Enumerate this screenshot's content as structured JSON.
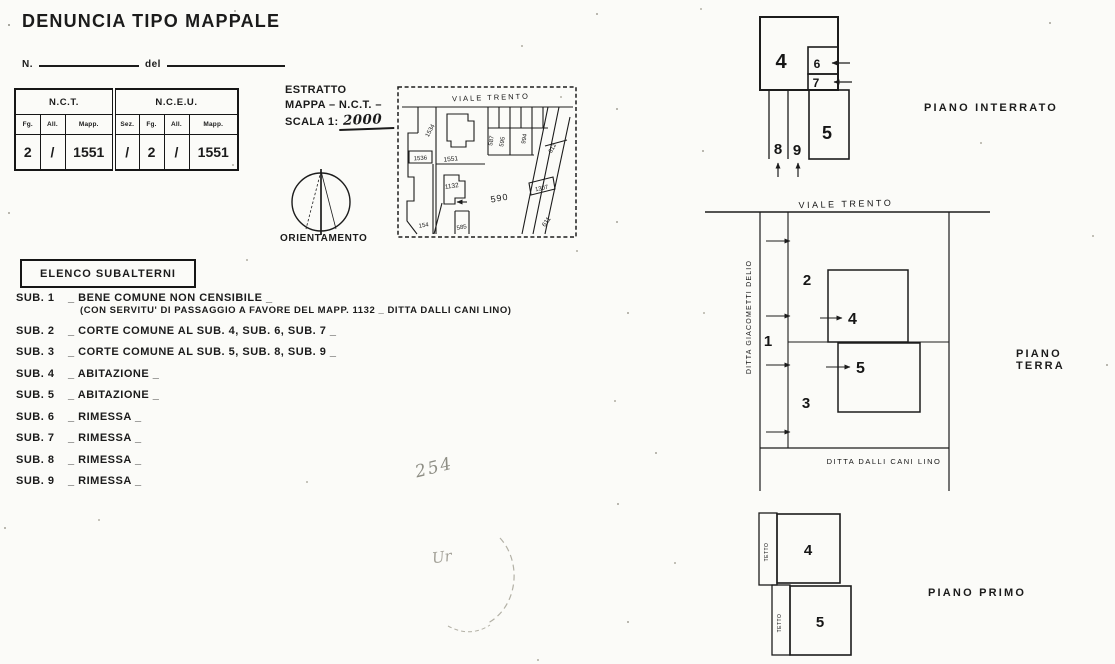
{
  "doc": {
    "title": "DENUNCIA TIPO MAPPALE",
    "n_label": "N.",
    "del_label": "del"
  },
  "table": {
    "groups": [
      "N.C.T.",
      "N.C.E.U."
    ],
    "cols": [
      "Fg.",
      "All.",
      "Mapp.",
      "Sez.",
      "Fg.",
      "All.",
      "Mapp."
    ],
    "vals": [
      "2",
      "/",
      "1551",
      "/",
      "2",
      "/",
      "1551"
    ]
  },
  "estratto": {
    "l1": "ESTRATTO",
    "l2": "MAPPA – N.C.T. –",
    "l3": "SCALA 1:",
    "scale": "2000"
  },
  "orientamento": "ORIENTAMENTO",
  "extract": {
    "street": "VIALE TRENTO",
    "labels": {
      "p1534": "1534",
      "p1536": "1536",
      "p1551": "1551",
      "p1132": "1132",
      "p587": "587",
      "p595": "595",
      "p994": "994",
      "p612": "612",
      "p590": "590",
      "p1307": "1307",
      "p611": "611",
      "p154": "154",
      "p585": "585"
    }
  },
  "elenco": {
    "title": "ELENCO SUBALTERNI",
    "items": [
      {
        "label": "SUB. 1",
        "desc": "_ BENE COMUNE NON CENSIBILE _",
        "note": "(CON SERVITU' DI PASSAGGIO A FAVORE DEL MAPP. 1132 _ DITTA DALLI CANI LINO)"
      },
      {
        "label": "SUB. 2",
        "desc": "_ CORTE COMUNE AL SUB. 4, SUB. 6, SUB. 7 _",
        "note": ""
      },
      {
        "label": "SUB. 3",
        "desc": "_ CORTE COMUNE AL SUB. 5, SUB. 8, SUB. 9 _",
        "note": ""
      },
      {
        "label": "SUB. 4",
        "desc": "_ ABITAZIONE _",
        "note": ""
      },
      {
        "label": "SUB. 5",
        "desc": "_ ABITAZIONE _",
        "note": ""
      },
      {
        "label": "SUB. 6",
        "desc": "_ RIMESSA _",
        "note": ""
      },
      {
        "label": "SUB. 7",
        "desc": "_ RIMESSA _",
        "note": ""
      },
      {
        "label": "SUB. 8",
        "desc": "_ RIMESSA _",
        "note": ""
      },
      {
        "label": "SUB. 9",
        "desc": "_ RIMESSA _",
        "note": ""
      }
    ]
  },
  "annotations": {
    "hw1": "254",
    "hw2": "Ur"
  },
  "plans": {
    "interrato": {
      "title": "PIANO INTERRATO",
      "u4": "4",
      "u5": "5",
      "u6": "6",
      "u7": "7",
      "u8": "8",
      "u9": "9"
    },
    "terra": {
      "title": "PIANO TERRA",
      "street": "VIALE TRENTO",
      "owner_left": "DITTA GIACOMETTI DELIO",
      "owner_bottom": "DITTA DALLI CANI LINO",
      "u1": "1",
      "u2": "2",
      "u3": "3",
      "u4": "4",
      "u5": "5"
    },
    "primo": {
      "title": "PIANO PRIMO",
      "tetto": "TETTO",
      "u4": "4",
      "u5": "5"
    }
  },
  "colors": {
    "ink": "#1b1b1b",
    "paper": "#fbfbf8",
    "pencil": "#8d8d84"
  }
}
